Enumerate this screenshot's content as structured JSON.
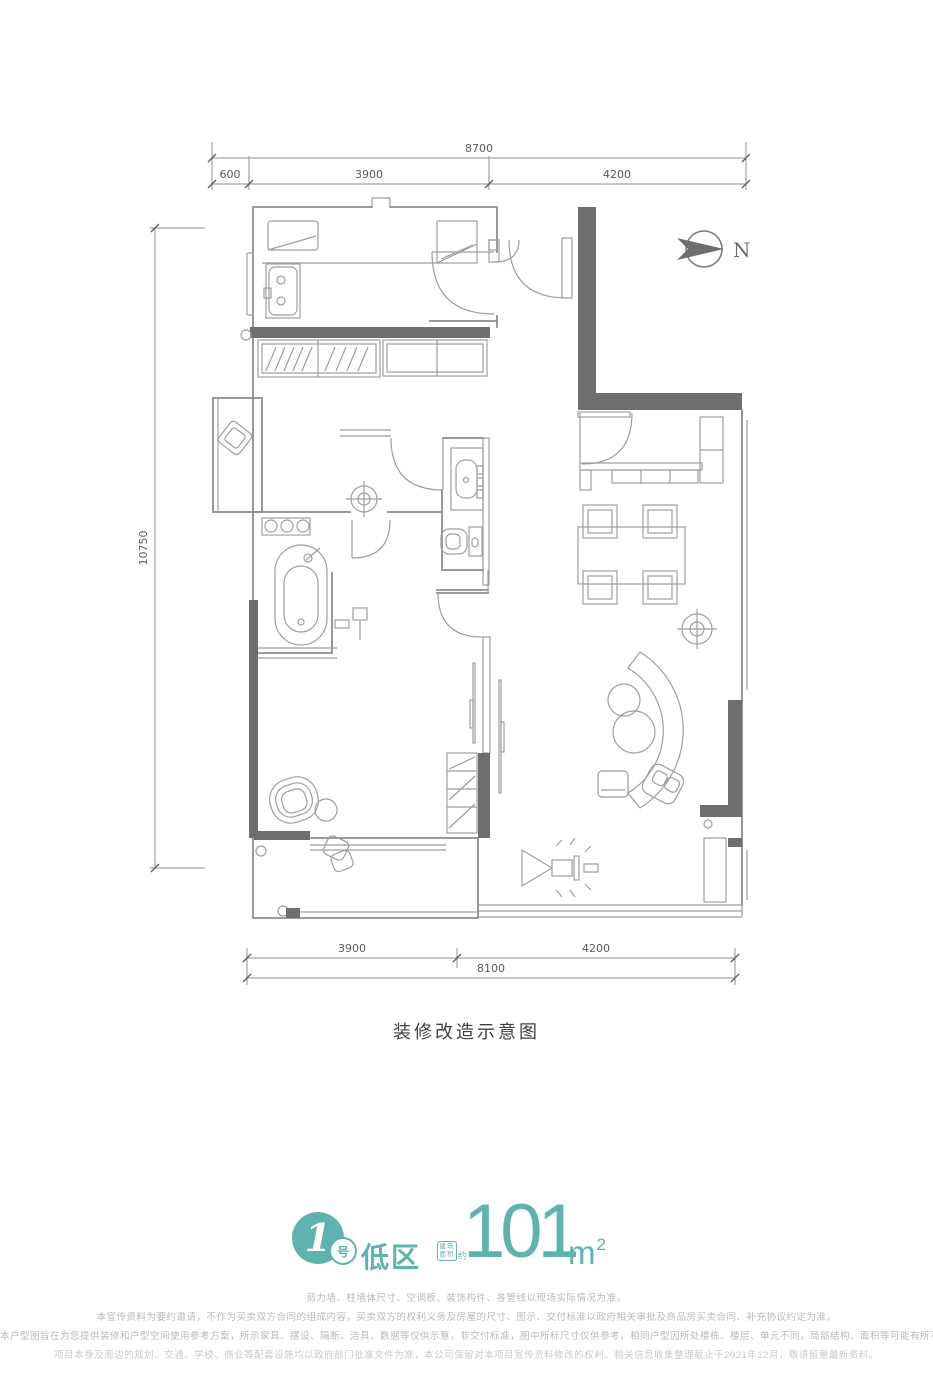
{
  "colors": {
    "accent": "#5fb3ae",
    "wall_dark": "#6e6e6e",
    "line": "#8d8d8d"
  },
  "north": {
    "label": "N"
  },
  "dimensions": {
    "top": {
      "total": "8700",
      "segments": [
        "600",
        "3900",
        "4200"
      ]
    },
    "left": {
      "total": "10750"
    },
    "bottom": {
      "segments": [
        "3900",
        "4200"
      ],
      "total": "8100"
    }
  },
  "caption": "装修改造示意图",
  "unit_badge": {
    "number": "1",
    "number_suffix": "号",
    "zone": "低区",
    "area_label_line1": "建筑",
    "area_label_line2": "面积",
    "area_label_approx": "约",
    "area_value": "101",
    "area_unit": "m",
    "area_unit_sup": "2"
  },
  "disclaimer": {
    "lines": [
      "剪力墙、柱墙体尺寸、空调板、装饰构件、各管线以现场实际情况为准。",
      "本宣传资料为要约邀请，不作为买卖双方合同的组成内容，买卖双方的权利义务及房屋的尺寸、图示、交付标准以政府相关审批及商品房买卖合同、补充协议约定为准。",
      "本户型图旨在为您提供装修和户型空间使用参考方案，所示家具、摆设、隔断、洁具、数据等仅供示意，非交付标准，图中所标尺寸仅供参考，相同户型因所处楼栋、楼层、单元不同，局部结构、面积等可能有所不同，以政府核准图纸为准。",
      "项目本身及周边的规划、交通、学校、商业等配套设施均以政府部门批准文件为准，本公司保留对本项目宣传资料修改的权利。相关信息收集整理截止于2021年12月，敬请留意最新资料。"
    ]
  }
}
